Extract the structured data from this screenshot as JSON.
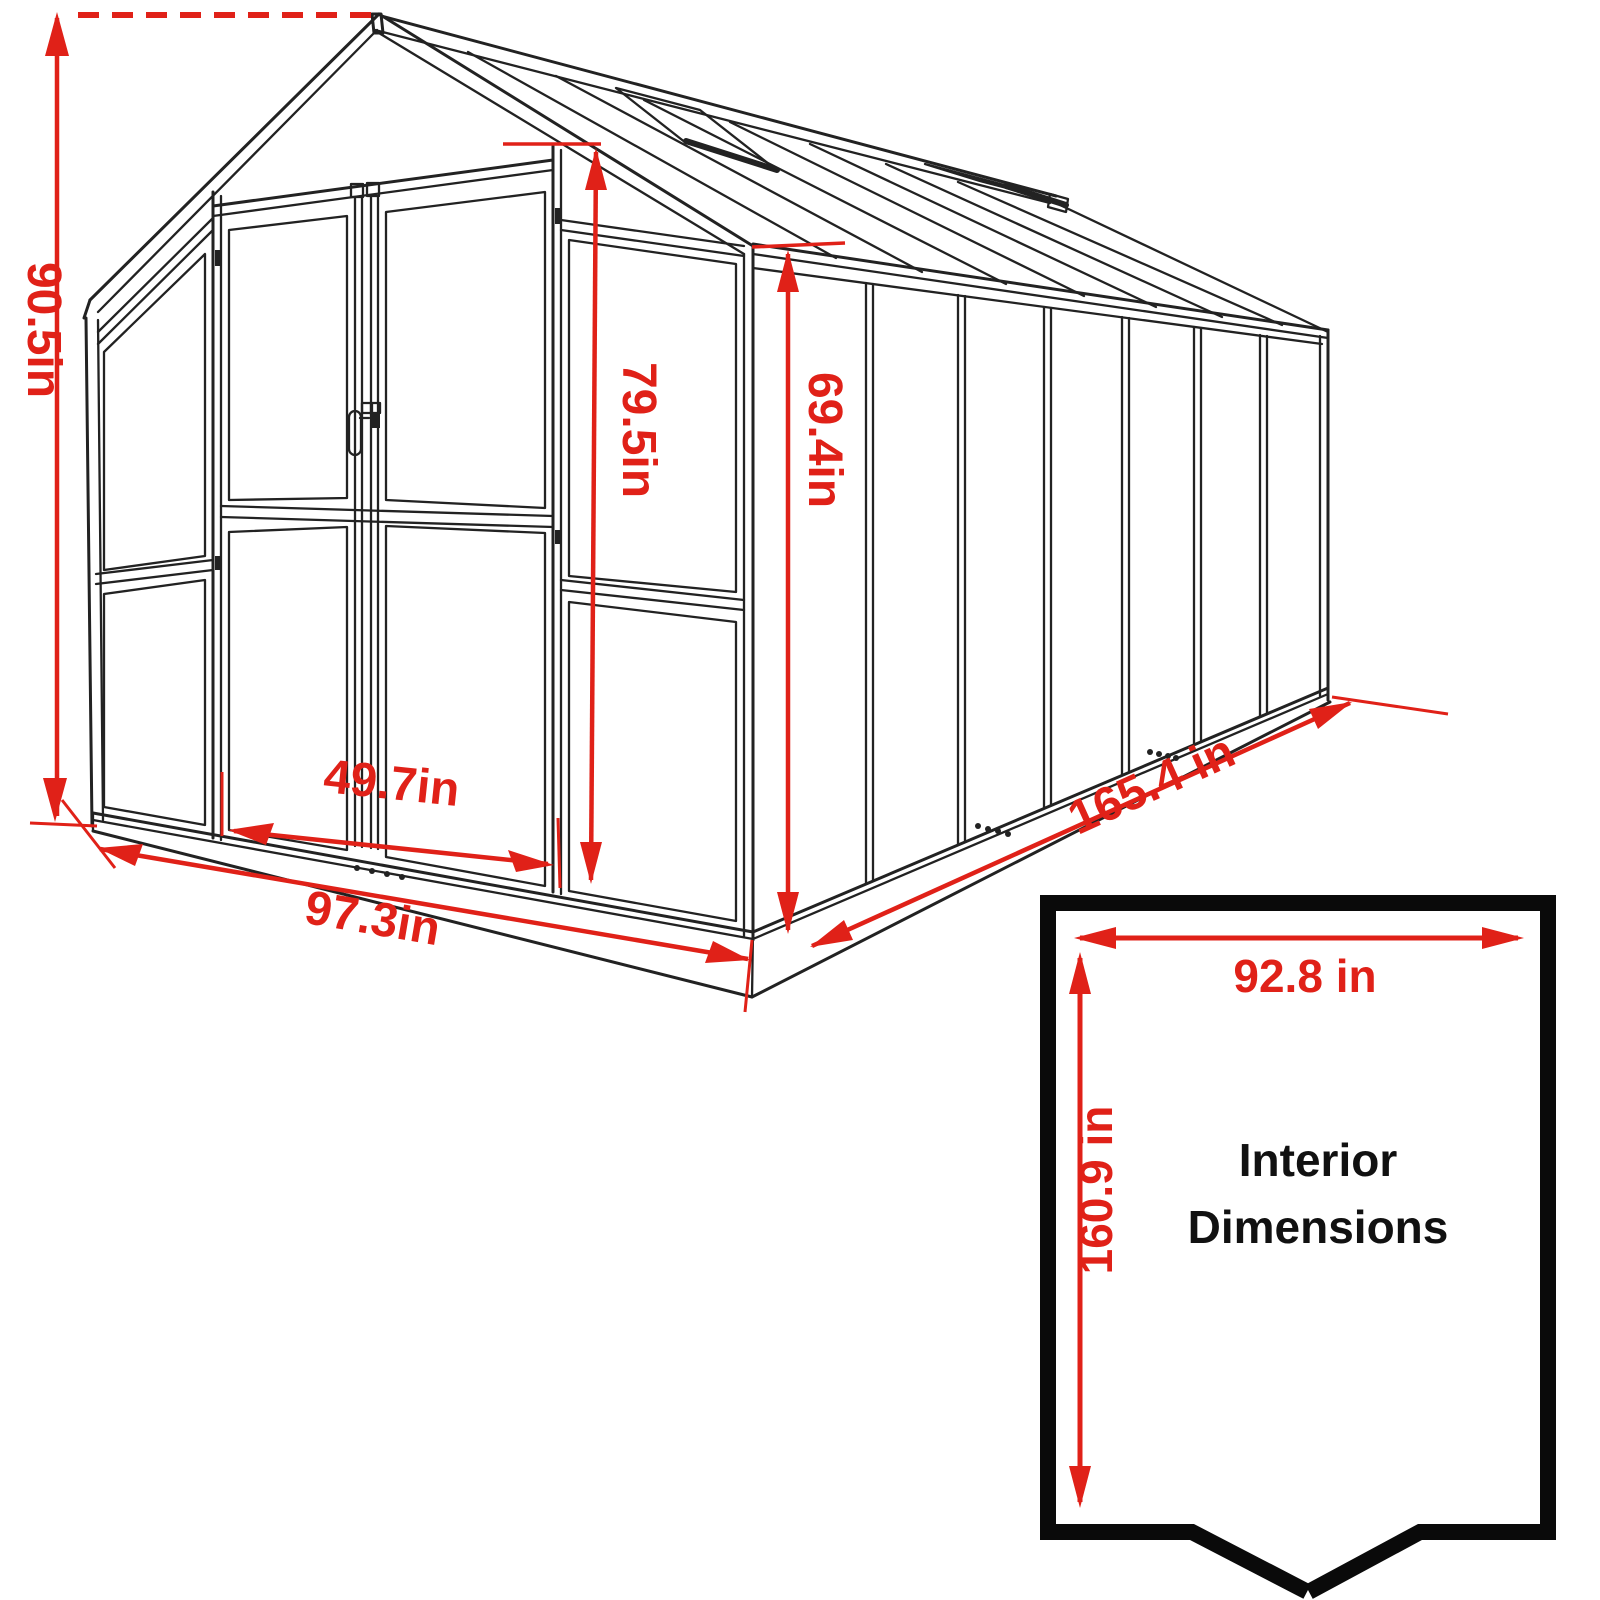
{
  "diagram": {
    "type": "greenhouse-dimension-drawing",
    "exterior_labels": {
      "overall_height": "90.5in",
      "door_height": "79.5in",
      "wall_height": "69.4in",
      "door_width": "49.7in",
      "front_width": "97.3in",
      "side_length": "165.4 in"
    },
    "interior_box": {
      "width_label": "92.8 in",
      "depth_label": "160.9 in",
      "caption_line1": "Interior",
      "caption_line2": "Dimensions"
    },
    "colors": {
      "dimension_red": "#e02118",
      "drawing_black": "#222222",
      "interior_border_black": "#0a0a0a",
      "background": "#ffffff"
    }
  }
}
